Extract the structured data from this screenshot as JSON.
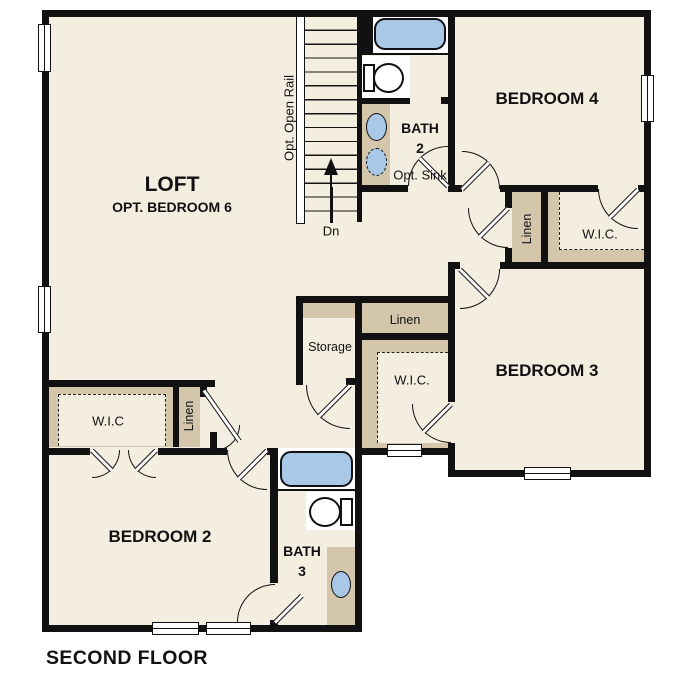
{
  "title": "SECOND FLOOR",
  "colors": {
    "floor": "#f4eee0",
    "casework": "#d3c6ab",
    "fixture_blue": "#a9c7e7",
    "wall": "#111111",
    "background": "#ffffff"
  },
  "rooms": {
    "loft": {
      "name": "LOFT",
      "subtitle": "OPT. BEDROOM 6"
    },
    "bedroom4": {
      "name": "BEDROOM 4"
    },
    "bedroom3": {
      "name": "BEDROOM 3"
    },
    "bedroom2": {
      "name": "BEDROOM 2"
    },
    "bath2": {
      "name": "BATH",
      "number": "2"
    },
    "bath3": {
      "name": "BATH",
      "number": "3"
    }
  },
  "closets": {
    "wic_bedroom4": "W.I.C.",
    "wic_bedroom3": "W.I.C.",
    "wic_bedroom2": "W.I.C",
    "linen_upper_hall": "Linen",
    "linen_hall": "Linen",
    "linen_bedroom2": "Linen",
    "storage": "Storage"
  },
  "stairs": {
    "rail_label": "Opt. Open Rail",
    "down_label": "Dn"
  },
  "annotations": {
    "optional_sink": "Opt. Sink"
  }
}
